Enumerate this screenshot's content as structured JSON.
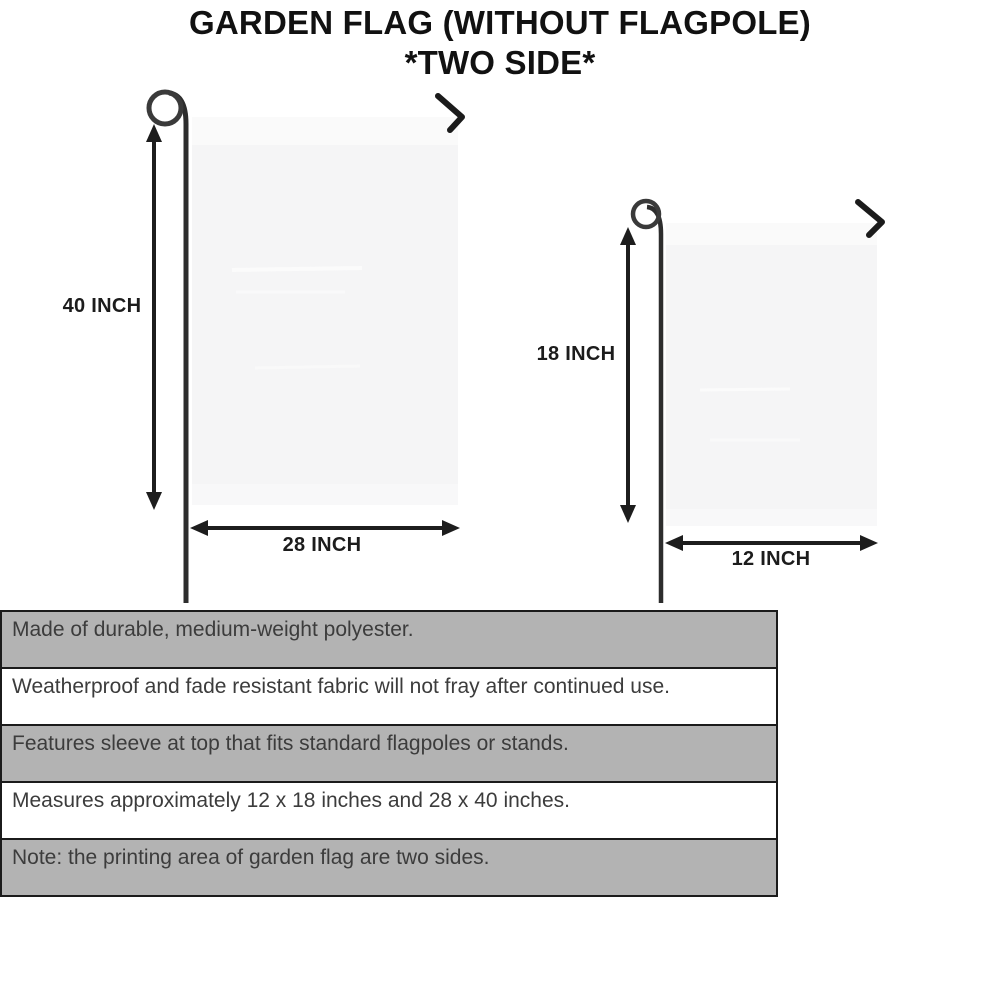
{
  "title": {
    "line1": "GARDEN FLAG (WITHOUT FLAGPOLE)",
    "line2": "*TWO SIDE*"
  },
  "diagram": {
    "large_flag": {
      "height_label": "40 INCH",
      "width_label": "28 INCH"
    },
    "small_flag": {
      "height_label": "18 INCH",
      "width_label": "12 INCH"
    }
  },
  "features": {
    "rows": [
      {
        "text": "Made of durable, medium-weight polyester.",
        "shaded": true
      },
      {
        "text": "Weatherproof and fade resistant fabric will not fray after continued use.",
        "shaded": false
      },
      {
        "text": "Features sleeve at top that fits standard flagpoles or stands.",
        "shaded": true
      },
      {
        "text": "Measures approximately 12 x 18 inches and 28 x 40 inches.",
        "shaded": false
      },
      {
        "text": "Note: the printing area of garden flag are two sides.",
        "shaded": true
      }
    ]
  },
  "colors": {
    "row_shaded": "#b3b3b3",
    "row_plain": "#ffffff",
    "table_border": "#1b1b1b",
    "flag_fill": "#f5f5f6",
    "flag_sleeve": "#fafafa",
    "line_art": "#1d1d1d",
    "pole": "#2d2d2d"
  }
}
